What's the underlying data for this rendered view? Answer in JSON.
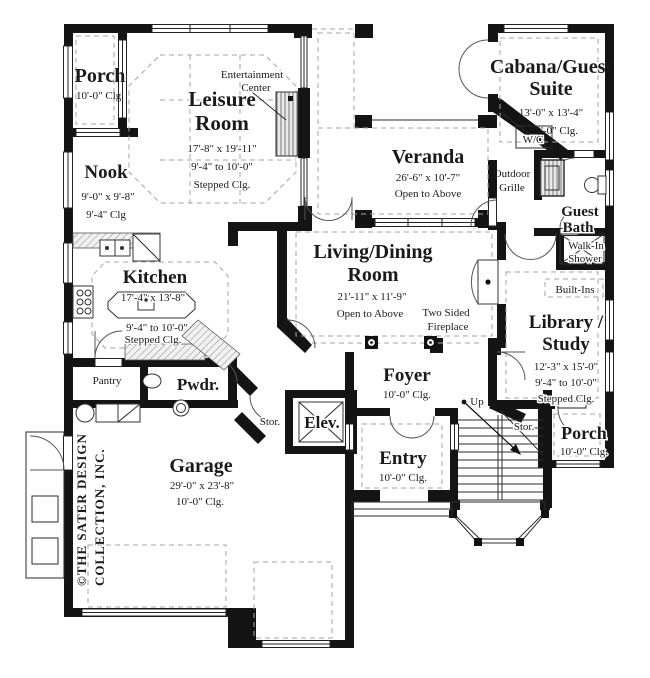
{
  "plan": {
    "colors": {
      "wall": "#141414",
      "dashed": "#a4a4a4",
      "hatch": "#8a8a8a",
      "paper": "#ffffff"
    },
    "copyright": {
      "line1": "©THE SATER DESIGN",
      "line2": "COLLECTION, INC."
    },
    "rooms": {
      "porch_top_left": {
        "name_lines": [
          "Porch"
        ],
        "dim_lines": [
          "10'-0\" Clg."
        ]
      },
      "leisure_room": {
        "name_lines": [
          "Leisure",
          "Room"
        ],
        "dim_lines": [
          "17'-8\" x 19'-11\"",
          "9'-4\" to 10'-0\"",
          "Stepped Clg."
        ]
      },
      "entertainment_center": {
        "name_lines": [
          "Entertainment",
          "Center"
        ]
      },
      "nook": {
        "name_lines": [
          "Nook"
        ],
        "dim_lines": [
          "9'-0\" x 9'-8\"",
          "9'-4\" Clg"
        ]
      },
      "kitchen": {
        "name_lines": [
          "Kitchen"
        ],
        "dim_lines": [
          "17'-4\" x 13'-8\"",
          "9'-4\" to 10'-0\"",
          "Stepped Clg."
        ]
      },
      "veranda": {
        "name_lines": [
          "Veranda"
        ],
        "dim_lines": [
          "26'-6\" x 10'-7\"",
          "Open to Above"
        ]
      },
      "cabana_guest_suite": {
        "name_lines": [
          "Cabana/Guest",
          "Suite"
        ],
        "dim_lines": [
          "13'-0\" x 13'-4\"",
          "10'-0\" Clg."
        ]
      },
      "wc": {
        "name_lines": [
          "W/C"
        ]
      },
      "outdoor_grille": {
        "name_lines": [
          "Outdoor",
          "Grille"
        ]
      },
      "guest_bath": {
        "name_lines": [
          "Guest",
          "Bath"
        ]
      },
      "walk_in_shower": {
        "name_lines": [
          "Walk-In",
          "Shower"
        ]
      },
      "built_ins": {
        "name_lines": [
          "Built-Ins"
        ]
      },
      "library_study": {
        "name_lines": [
          "Library /",
          "Study"
        ],
        "dim_lines": [
          "12'-3\" x 15'-0\"",
          "9'-4\" to 10'-0\"",
          "Stepped Clg."
        ]
      },
      "living_dining": {
        "name_lines": [
          "Living/Dining",
          "Room"
        ],
        "dim_lines": [
          "21'-11\" x 11'-9\"",
          "Open to Above"
        ]
      },
      "two_sided_fireplace": {
        "name_lines": [
          "Two Sided",
          "Fireplace"
        ]
      },
      "foyer": {
        "name_lines": [
          "Foyer"
        ],
        "dim_lines": [
          "10'-0\" Clg."
        ]
      },
      "pantry": {
        "name_lines": [
          "Pantry"
        ]
      },
      "powder": {
        "name_lines": [
          "Pwdr."
        ]
      },
      "storage_1": {
        "name_lines": [
          "Stor."
        ]
      },
      "elevator": {
        "name_lines": [
          "Elev."
        ]
      },
      "garage": {
        "name_lines": [
          "Garage"
        ],
        "dim_lines": [
          "29'-0\" x 23'-8\"",
          "10'-0\" Clg."
        ]
      },
      "entry": {
        "name_lines": [
          "Entry"
        ],
        "dim_lines": [
          "10'-0\" Clg."
        ]
      },
      "up": {
        "name_lines": [
          "Up"
        ]
      },
      "storage_2": {
        "name_lines": [
          "Stor."
        ]
      },
      "porch_bottom_right": {
        "name_lines": [
          "Porch"
        ],
        "dim_lines": [
          "10'-0\" Clg."
        ]
      }
    }
  }
}
